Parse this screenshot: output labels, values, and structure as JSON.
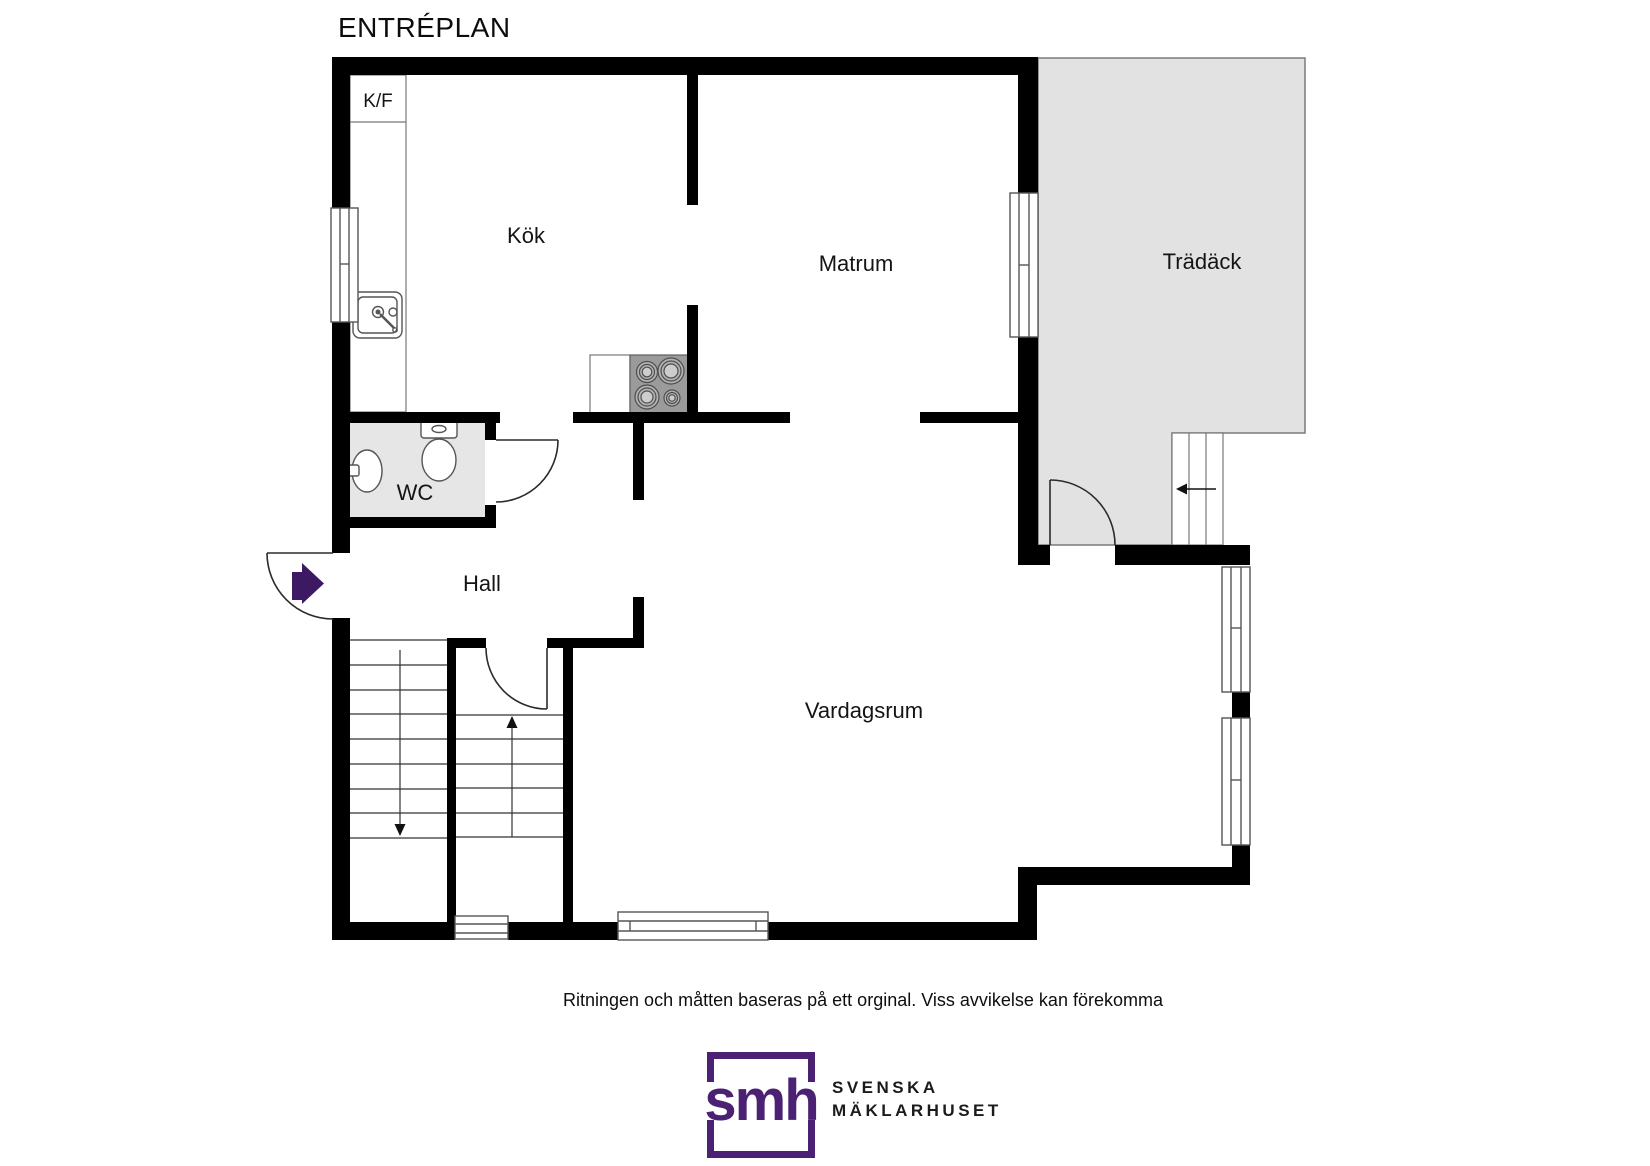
{
  "page": {
    "title": "ENTRÉPLAN",
    "disclaimer": "Ritningen och måtten baseras på ett orginal. Viss avvikelse kan förekomma"
  },
  "rooms": {
    "kok": "Kök",
    "matrum": "Matrum",
    "tradack": "Trädäck",
    "wc": "WC",
    "hall": "Hall",
    "vardagsrum": "Vardagsrum"
  },
  "kitchen": {
    "fridge_freezer_label": "K/F"
  },
  "logo": {
    "monogram": "smh",
    "line1": "SVENSKA",
    "line2": "MÄKLARHUSET"
  },
  "colors": {
    "wall": "#000000",
    "deck": "#e2e2e2",
    "wc_floor": "#e6e6e6",
    "stove": "#9b9b9b",
    "entry_arrow": "#3d1963",
    "logo_purple": "#4b2173"
  }
}
